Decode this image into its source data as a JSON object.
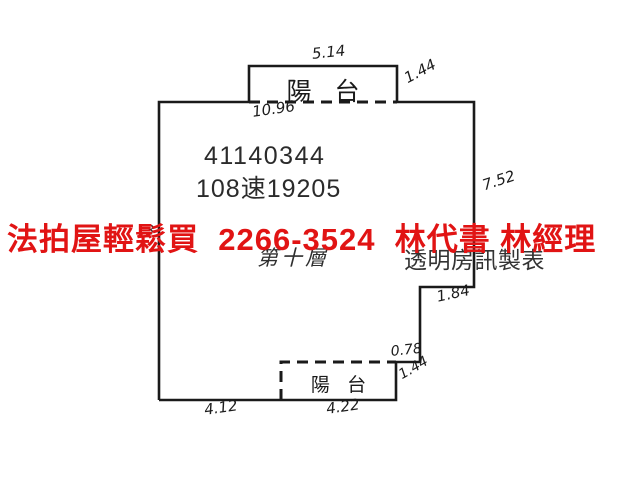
{
  "plan": {
    "registration_number": "41140344",
    "case_number": "108速19205",
    "floor_label": "第十層",
    "publisher_label": "透明房訊製表",
    "top_balcony_label": "陽 台",
    "bottom_balcony_label": "陽 台",
    "dimensions": {
      "top_balcony_width": "5.14",
      "top_balcony_depth": "1.44",
      "top_wall_width": "10.96",
      "right_wall_depth": "7.52",
      "right_step_width": "1.84",
      "right_notch_width": "0.78",
      "bottom_right_depth": "1.44",
      "bottom_balcony_width": "4.22",
      "bottom_left_width": "4.12",
      "obscured_mark": "3"
    }
  },
  "overlay": {
    "ad_text": "法拍屋輕鬆買  2266-3524  林代書 林經理"
  },
  "colors": {
    "ad_red": "#e11414",
    "line_black": "#1a1a1a",
    "text_dark": "#2b2b2b"
  }
}
